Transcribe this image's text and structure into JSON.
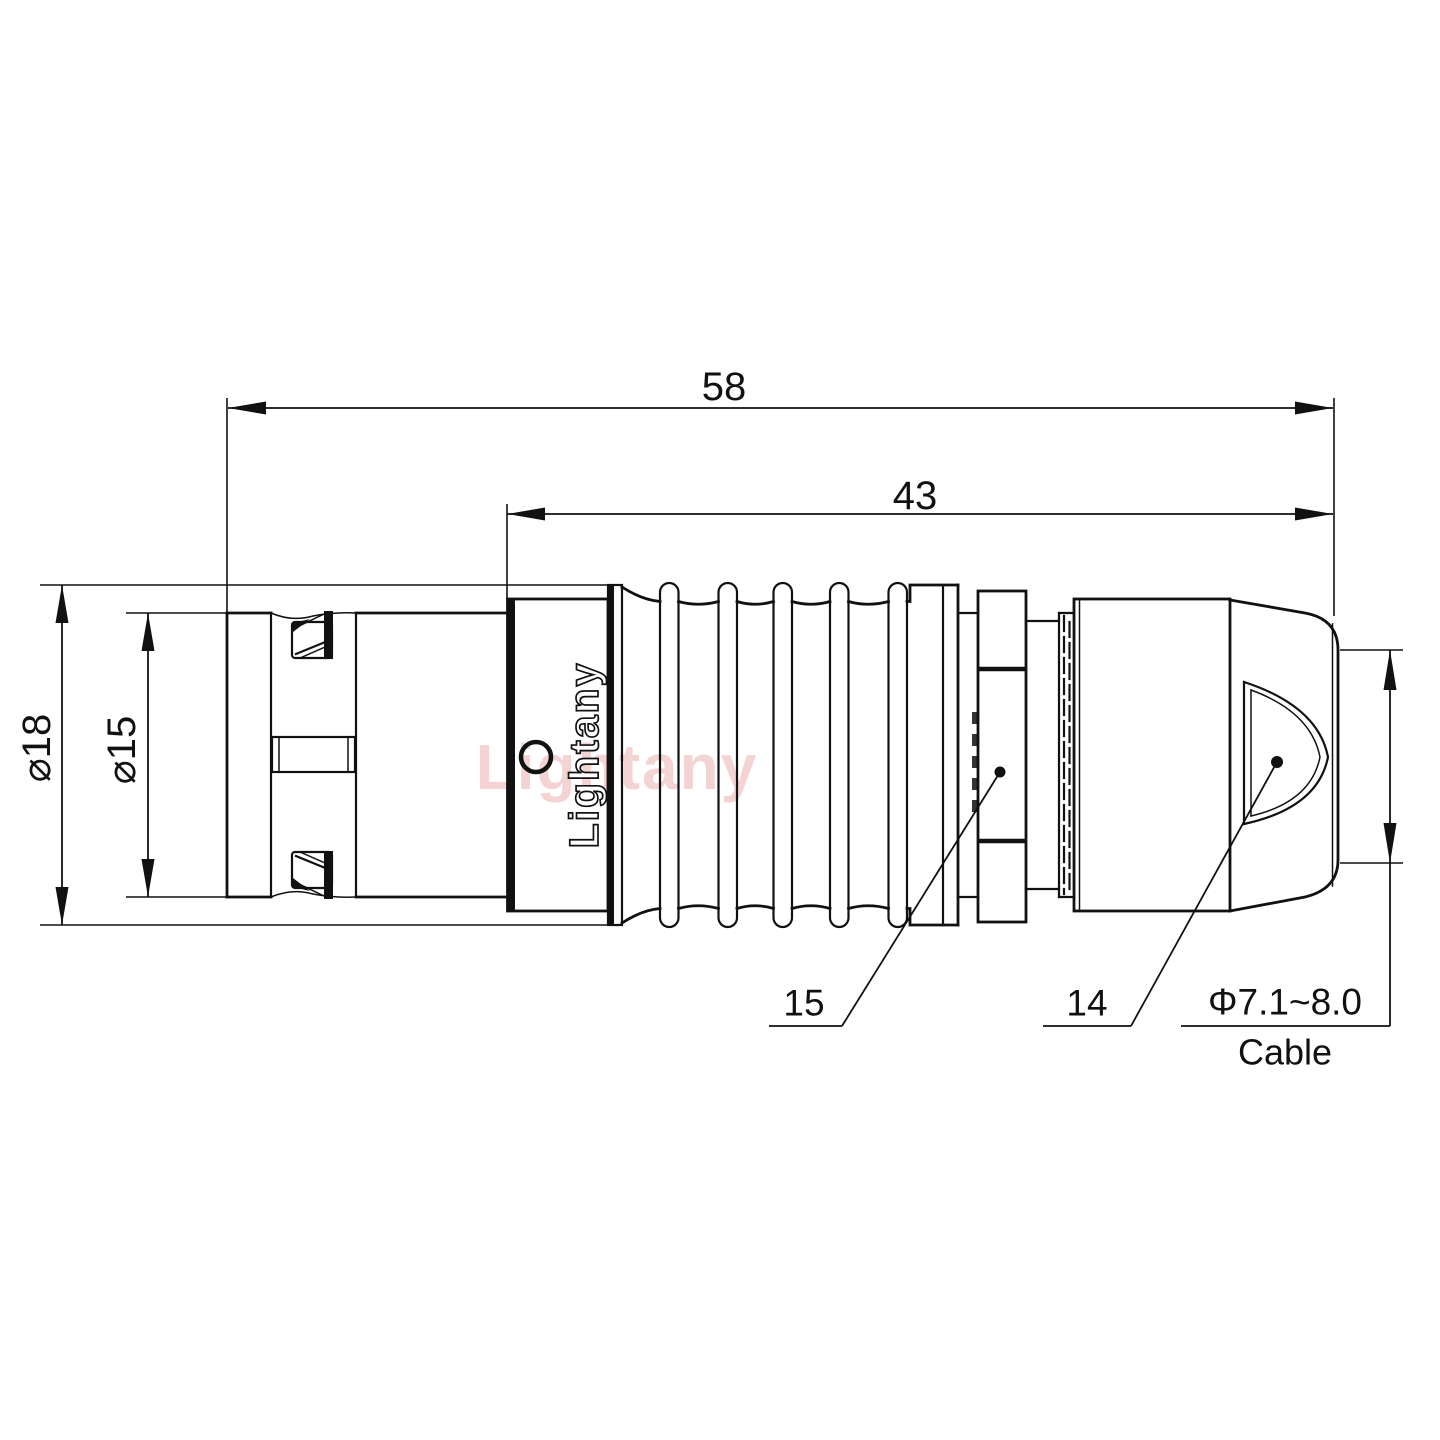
{
  "drawing": {
    "dimensions": {
      "overall_length": "58",
      "rear_length": "43",
      "outer_diameter": "⌀18",
      "front_diameter": "⌀15",
      "cable_range": "Φ7.1~8.0",
      "cable_label": "Cable"
    },
    "part_numbers": {
      "clamp_nut": "15",
      "backshell": "14"
    },
    "branding": {
      "body_marking": "Lightany",
      "watermark": "Lightany"
    }
  },
  "colors": {
    "line": "#111111",
    "watermark_pink": "#eba8a8",
    "background": "#ffffff"
  }
}
